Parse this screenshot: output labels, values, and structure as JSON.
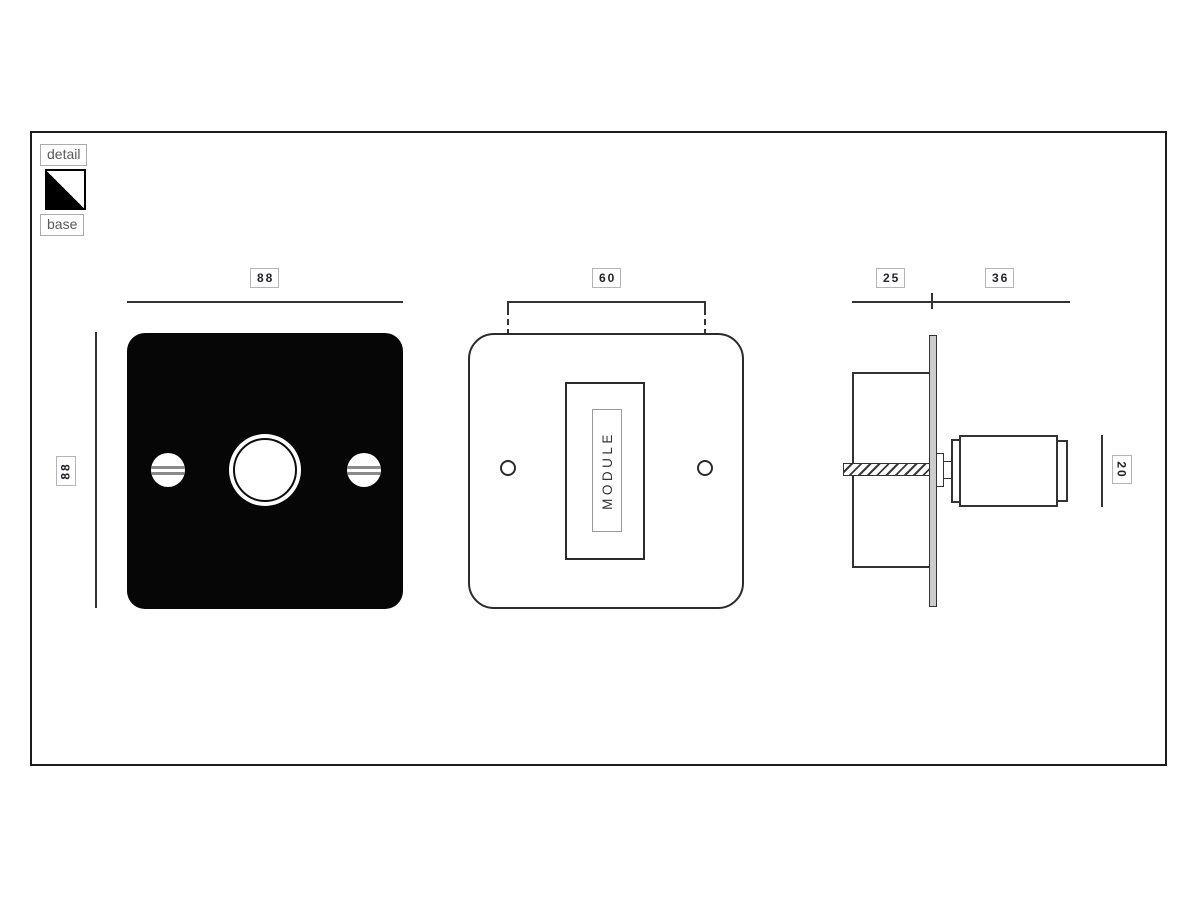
{
  "legend": {
    "detail": "detail",
    "base": "base"
  },
  "dimensions": {
    "front_width": "88",
    "front_height": "88",
    "screw_spacing": "60",
    "box_depth": "25",
    "knob_protrusion": "36",
    "knob_diameter": "20"
  },
  "module_label": "MODULE",
  "colors": {
    "plate_black": "#060606",
    "line": "#333333",
    "label_border": "#b5b5b5",
    "side_plate_fill": "#cdcdcd",
    "swatch_base": "#000000",
    "swatch_detail": "#ffffff"
  }
}
